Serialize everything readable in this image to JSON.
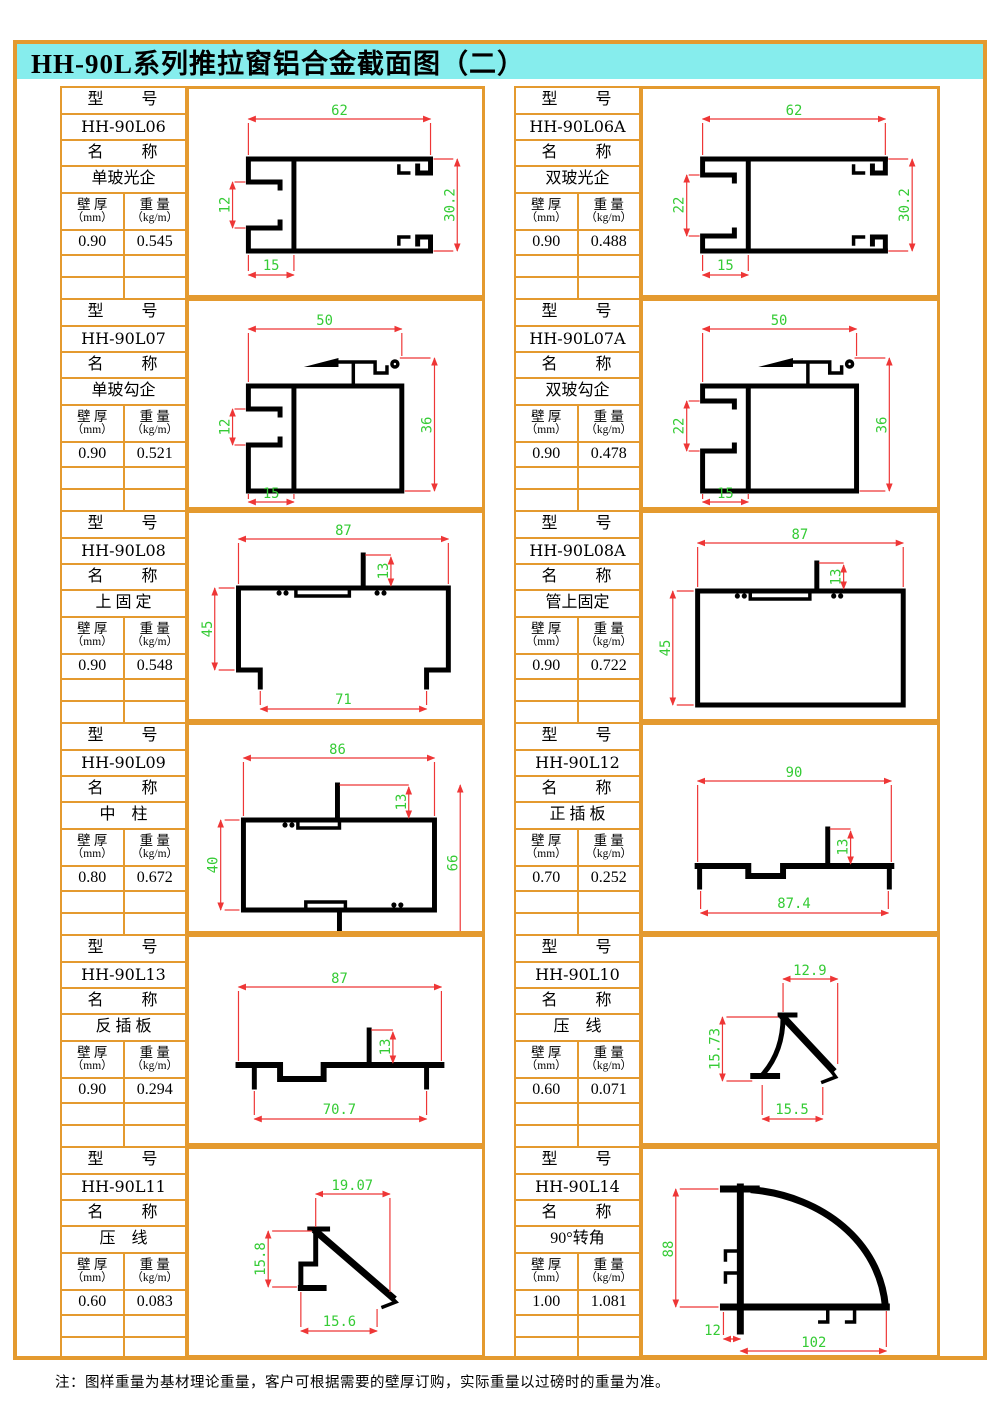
{
  "page": {
    "title": "HH-90L系列推拉窗铝合金截面图（二）",
    "footer_note": "注：图样重量为基材理论重量，客户可根据需要的壁厚订购，实际重量以过磅时的重量为准。"
  },
  "labels": {
    "model": "型　　号",
    "name": "名　　称",
    "thickness": "壁 厚",
    "thickness_unit": "（mm）",
    "weight": "重 量",
    "weight_unit": "（kg/m）"
  },
  "colors": {
    "frame_orange": "#E49A2F",
    "title_bg_cyan": "#86EDED",
    "dim_line_red": "#EE3636",
    "dim_text_green": "#35CB35",
    "profile_black": "#000000"
  },
  "units": [
    {
      "model": "HH-90L06",
      "name": "单玻光企",
      "thickness": "0.90",
      "weight": "0.545",
      "dims": [
        "62",
        "12",
        "30.2",
        "15"
      ]
    },
    {
      "model": "HH-90L06A",
      "name": "双玻光企",
      "thickness": "0.90",
      "weight": "0.488",
      "dims": [
        "62",
        "22",
        "30.2",
        "15"
      ]
    },
    {
      "model": "HH-90L07",
      "name": "单玻勾企",
      "thickness": "0.90",
      "weight": "0.521",
      "dims": [
        "50",
        "12",
        "36",
        "15"
      ]
    },
    {
      "model": "HH-90L07A",
      "name": "双玻勾企",
      "thickness": "0.90",
      "weight": "0.478",
      "dims": [
        "50",
        "22",
        "36",
        "15"
      ]
    },
    {
      "model": "HH-90L08",
      "name": "上 固 定",
      "thickness": "0.90",
      "weight": "0.548",
      "dims": [
        "87",
        "13",
        "45",
        "71"
      ]
    },
    {
      "model": "HH-90L08A",
      "name": "管上固定",
      "thickness": "0.90",
      "weight": "0.722",
      "dims": [
        "87",
        "13",
        "45"
      ]
    },
    {
      "model": "HH-90L09",
      "name": "中　柱",
      "thickness": "0.80",
      "weight": "0.672",
      "dims": [
        "86",
        "13",
        "40",
        "66"
      ]
    },
    {
      "model": "HH-90L12",
      "name": "正 插 板",
      "thickness": "0.70",
      "weight": "0.252",
      "dims": [
        "90",
        "13",
        "87.4"
      ]
    },
    {
      "model": "HH-90L13",
      "name": "反 插 板",
      "thickness": "0.90",
      "weight": "0.294",
      "dims": [
        "87",
        "13",
        "70.7"
      ]
    },
    {
      "model": "HH-90L10",
      "name": "压　线",
      "thickness": "0.60",
      "weight": "0.071",
      "dims": [
        "12.9",
        "15.73",
        "15.5"
      ]
    },
    {
      "model": "HH-90L11",
      "name": "压　线",
      "thickness": "0.60",
      "weight": "0.083",
      "dims": [
        "19.07",
        "15.8",
        "15.6"
      ]
    },
    {
      "model": "HH-90L14",
      "name": "90°转角",
      "thickness": "1.00",
      "weight": "1.081",
      "dims": [
        "88",
        "12",
        "102"
      ]
    }
  ]
}
